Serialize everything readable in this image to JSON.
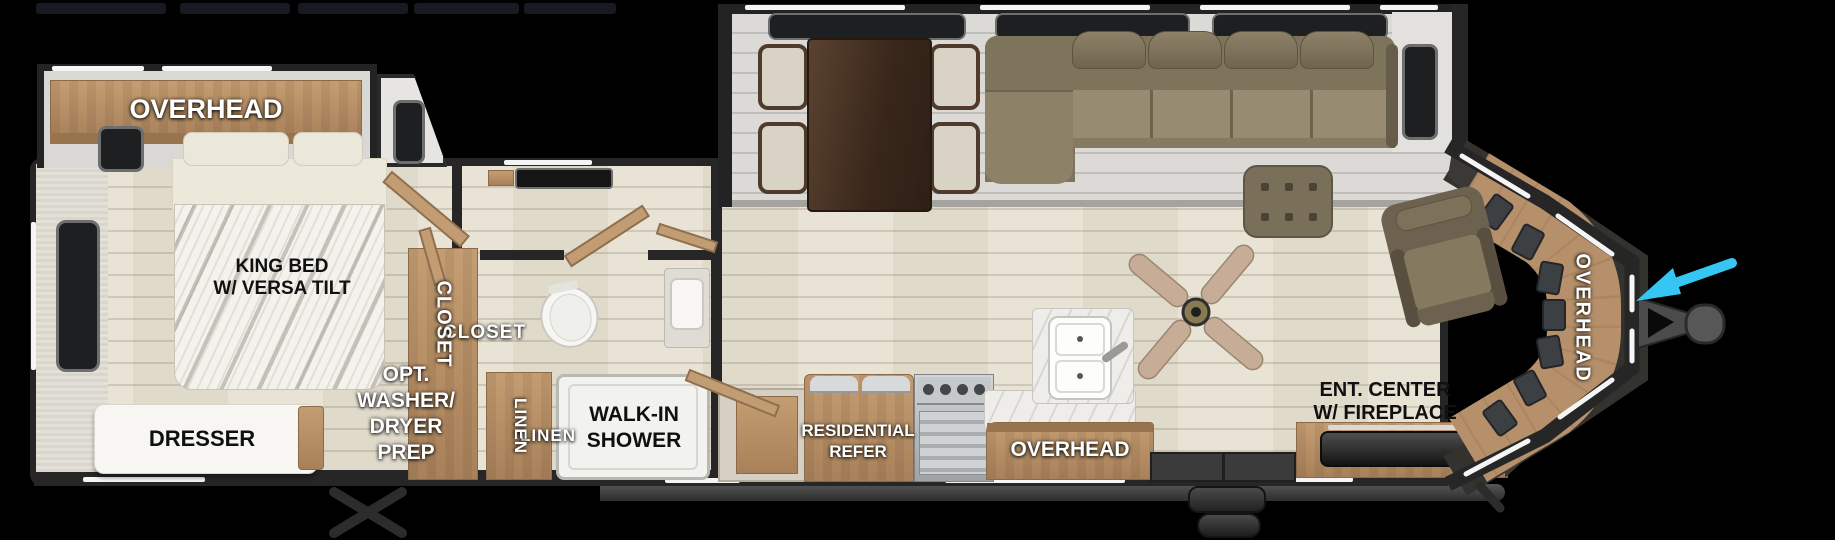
{
  "canvas": {
    "width": 1835,
    "height": 540,
    "background": "#000000"
  },
  "colors": {
    "wall": "#262626",
    "wood_cabinet": "#b5906a",
    "wood_cabinet_dark": "#97744e",
    "floor": "#e8e2d4",
    "slide_floor": "#dbdad6",
    "sofa": "#8d8268",
    "table_wood": "#4a3424",
    "marble_counter": "#efede9",
    "accent_white": "#f5f5f5",
    "entry_arrow_blue": "#35c6f3",
    "label_white": "#ffffff",
    "label_black": "#101010"
  },
  "labels": {
    "bedroom_overhead": "OVERHEAD",
    "bed": [
      "KING BED",
      "W/ VERSA TILT"
    ],
    "dresser": "DRESSER",
    "closet": "CLOSET",
    "washer_prep": [
      "OPT.",
      "WASHER/",
      "DRYER",
      "PREP"
    ],
    "linen": "LINEN",
    "shower": [
      "WALK-IN",
      "SHOWER"
    ],
    "refer": [
      "RESIDENTIAL",
      "REFER"
    ],
    "kitchen_overhead": "OVERHEAD",
    "ent_center": [
      "ENT. CENTER",
      "W/ FIREPLACE"
    ],
    "front_overhead": "OVERHEAD"
  }
}
